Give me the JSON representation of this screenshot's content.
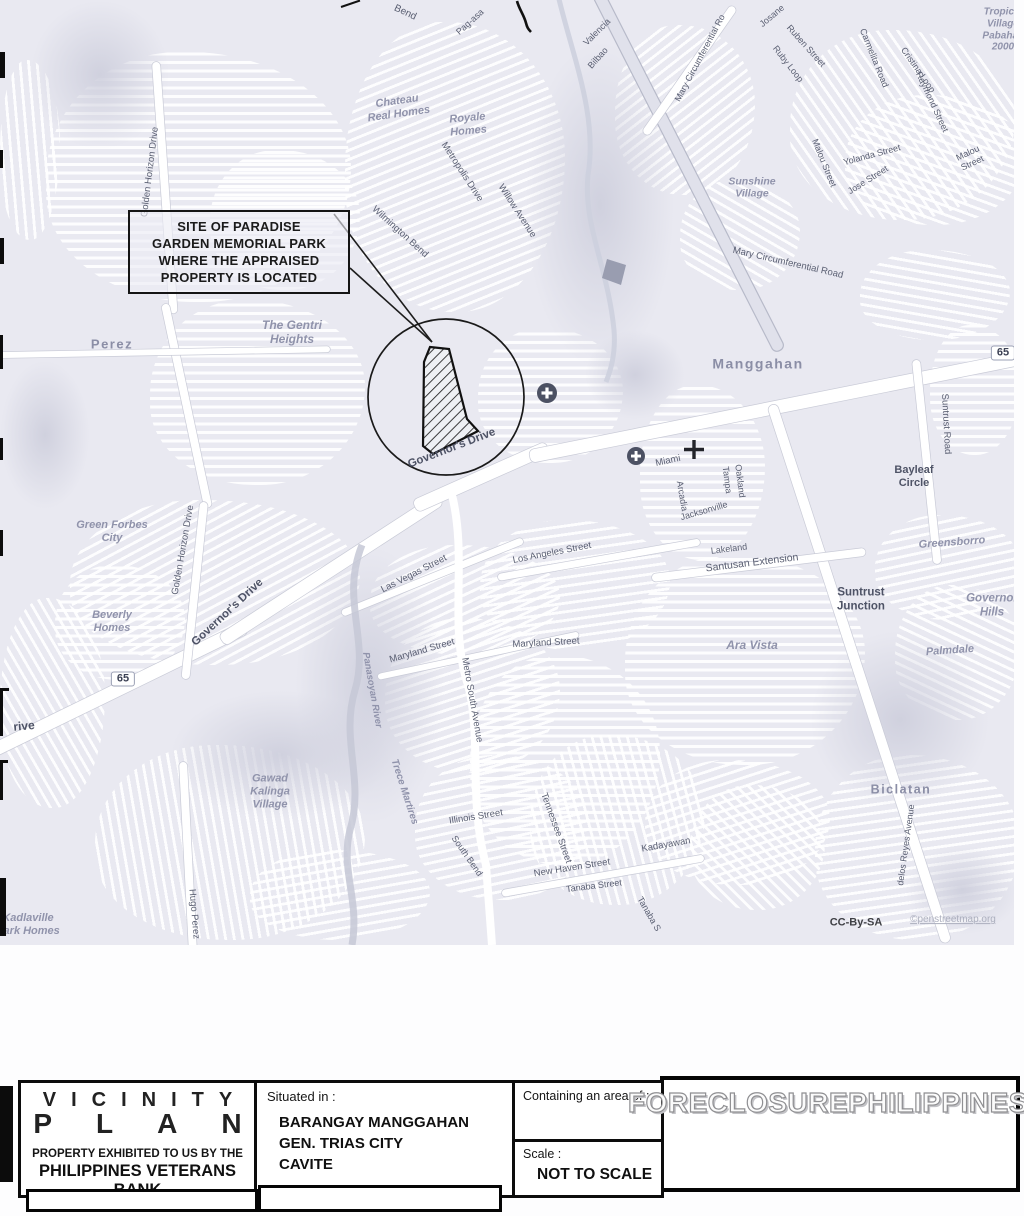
{
  "map": {
    "callout": {
      "text": "SITE OF PARADISE\nGARDEN MEMORIAL PARK\nWHERE THE APPRAISED\nPROPERTY IS LOCATED"
    },
    "labels": [
      {
        "t": "Bend",
        "x": 405,
        "y": 13,
        "r": 25,
        "c": "st",
        "s": 10
      },
      {
        "t": "Pag-asa",
        "x": 470,
        "y": 22,
        "r": -42,
        "c": "st",
        "s": 9
      },
      {
        "t": "Chateau\nReal Homes",
        "x": 398,
        "y": 108,
        "r": -8,
        "c": "pl",
        "s": 11
      },
      {
        "t": "Wilmington Bend",
        "x": 400,
        "y": 232,
        "r": 42,
        "c": "st",
        "s": 9.5
      },
      {
        "t": "Royale\nHomes",
        "x": 468,
        "y": 125,
        "r": -5,
        "c": "pl",
        "s": 11
      },
      {
        "t": "Metropolis Drive",
        "x": 462,
        "y": 172,
        "r": 57,
        "c": "st",
        "s": 9.5
      },
      {
        "t": "Willow Avenue",
        "x": 517,
        "y": 211,
        "r": 57,
        "c": "st",
        "s": 9.5
      },
      {
        "t": "Valencia",
        "x": 597,
        "y": 32,
        "r": -45,
        "c": "st",
        "s": 9
      },
      {
        "t": "Bilbao",
        "x": 598,
        "y": 58,
        "r": -48,
        "c": "st",
        "s": 9
      },
      {
        "t": "Mary Circumferential Ro",
        "x": 700,
        "y": 58,
        "r": -62,
        "c": "st",
        "s": 9
      },
      {
        "t": "Josane",
        "x": 772,
        "y": 16,
        "r": -40,
        "c": "st",
        "s": 9
      },
      {
        "t": "Ruben Street",
        "x": 806,
        "y": 46,
        "r": 48,
        "c": "st",
        "s": 9
      },
      {
        "t": "Ruby Loop",
        "x": 788,
        "y": 64,
        "r": 52,
        "c": "st",
        "s": 9
      },
      {
        "t": "Carmelita Road",
        "x": 874,
        "y": 58,
        "r": 68,
        "c": "st",
        "s": 9
      },
      {
        "t": "Cristina Loop",
        "x": 918,
        "y": 70,
        "r": 55,
        "c": "st",
        "s": 9
      },
      {
        "t": "Raymond Street",
        "x": 932,
        "y": 102,
        "r": 65,
        "c": "st",
        "s": 9
      },
      {
        "t": "Tropical\nVillage\nPabahay\n2000",
        "x": 1003,
        "y": 30,
        "r": 0,
        "c": "pl",
        "s": 10
      },
      {
        "t": "Yolanda Street",
        "x": 872,
        "y": 155,
        "r": -15,
        "c": "st",
        "s": 9
      },
      {
        "t": "Malou Street",
        "x": 824,
        "y": 163,
        "r": 68,
        "c": "st",
        "s": 9
      },
      {
        "t": "Jose Street",
        "x": 868,
        "y": 180,
        "r": -32,
        "c": "st",
        "s": 9
      },
      {
        "t": "Malou Street",
        "x": 970,
        "y": 158,
        "r": -25,
        "c": "st",
        "s": 9
      },
      {
        "t": "Sunshine\nVillage",
        "x": 752,
        "y": 188,
        "r": 0,
        "c": "pl",
        "s": 10.5
      },
      {
        "t": "Mary Circumferential Road",
        "x": 788,
        "y": 263,
        "r": 13,
        "c": "st",
        "s": 9.5
      },
      {
        "t": "Manggahan",
        "x": 758,
        "y": 364,
        "r": 0,
        "c": "town",
        "s": 14
      },
      {
        "t": "65",
        "x": 1003,
        "y": 353,
        "r": 0,
        "c": "shield",
        "s": 11
      },
      {
        "t": "Suntrust Road",
        "x": 946,
        "y": 424,
        "r": 87,
        "c": "st",
        "s": 9.5
      },
      {
        "t": "Bayleaf\nCircle",
        "x": 914,
        "y": 477,
        "r": 0,
        "c": "stb",
        "s": 11
      },
      {
        "t": "Governor's Drive",
        "x": 452,
        "y": 449,
        "r": -21,
        "c": "stb",
        "s": 11.5
      },
      {
        "t": "Governor's Drive",
        "x": 228,
        "y": 613,
        "r": -43,
        "c": "stb",
        "s": 11.5
      },
      {
        "t": "Golden Horizon Drive",
        "x": 150,
        "y": 172,
        "r": -83,
        "c": "st",
        "s": 9.5
      },
      {
        "t": "Golden Horizon Drive",
        "x": 183,
        "y": 550,
        "r": -80,
        "c": "st",
        "s": 9.5
      },
      {
        "t": "Perez",
        "x": 112,
        "y": 344,
        "r": 0,
        "c": "town",
        "s": 13
      },
      {
        "t": "The Gentri\nHeights",
        "x": 292,
        "y": 332,
        "r": 0,
        "c": "pl",
        "s": 12
      },
      {
        "t": "Green Forbes\nCity",
        "x": 112,
        "y": 532,
        "r": 0,
        "c": "pl",
        "s": 11
      },
      {
        "t": "Beverly\nHomes",
        "x": 112,
        "y": 622,
        "r": 0,
        "c": "pl",
        "s": 11
      },
      {
        "t": "65",
        "x": 123,
        "y": 679,
        "r": 0,
        "c": "shield",
        "s": 11
      },
      {
        "t": "rive",
        "x": 24,
        "y": 726,
        "r": -5,
        "c": "stb",
        "s": 12
      },
      {
        "t": "Las Vegas Street",
        "x": 414,
        "y": 574,
        "r": -27,
        "c": "st",
        "s": 9.5
      },
      {
        "t": "Los Angeles Street",
        "x": 552,
        "y": 553,
        "r": -11,
        "c": "st",
        "s": 9.5
      },
      {
        "t": "Maryland Street",
        "x": 422,
        "y": 651,
        "r": -16,
        "c": "st",
        "s": 9.5
      },
      {
        "t": "Maryland Street",
        "x": 546,
        "y": 643,
        "r": -3,
        "c": "st",
        "s": 9.5
      },
      {
        "t": "Metro South Avenue",
        "x": 472,
        "y": 700,
        "r": 80,
        "c": "st",
        "s": 9.5
      },
      {
        "t": "Panasoyan River",
        "x": 372,
        "y": 690,
        "r": 80,
        "c": "pl",
        "s": 9.5
      },
      {
        "t": "Trece Martires",
        "x": 404,
        "y": 792,
        "r": 72,
        "c": "pl",
        "s": 10
      },
      {
        "t": "Illinois Street",
        "x": 476,
        "y": 817,
        "r": -9,
        "c": "st",
        "s": 9.5
      },
      {
        "t": "South Bend",
        "x": 467,
        "y": 856,
        "r": 55,
        "c": "st",
        "s": 9
      },
      {
        "t": "Tennessee Street",
        "x": 556,
        "y": 828,
        "r": 70,
        "c": "st",
        "s": 9.5
      },
      {
        "t": "New Haven Street",
        "x": 572,
        "y": 868,
        "r": -9,
        "c": "st",
        "s": 9.5
      },
      {
        "t": "Tanaba Street",
        "x": 594,
        "y": 886,
        "r": -7,
        "c": "st",
        "s": 9
      },
      {
        "t": "Tanaba S",
        "x": 649,
        "y": 914,
        "r": 60,
        "c": "st",
        "s": 9
      },
      {
        "t": "Kadayawan",
        "x": 666,
        "y": 845,
        "r": -10,
        "c": "st",
        "s": 9.5
      },
      {
        "t": "Gawad\nKalinga\nVillage",
        "x": 270,
        "y": 792,
        "r": 0,
        "c": "pl",
        "s": 11
      },
      {
        "t": "Hugo Perez",
        "x": 194,
        "y": 914,
        "r": 85,
        "c": "st",
        "s": 9.5
      },
      {
        "t": "Kadlaville\nPark Homes",
        "x": 28,
        "y": 925,
        "r": 0,
        "c": "pl",
        "s": 11
      },
      {
        "t": "Ara Vista",
        "x": 752,
        "y": 645,
        "r": 0,
        "c": "pl",
        "s": 12
      },
      {
        "t": "Suntrust\nJunction",
        "x": 861,
        "y": 600,
        "r": 0,
        "c": "stb",
        "s": 11.5
      },
      {
        "t": "Greensborro",
        "x": 952,
        "y": 543,
        "r": -4,
        "c": "pl",
        "s": 11
      },
      {
        "t": "Governor\nHills",
        "x": 992,
        "y": 606,
        "r": 0,
        "c": "pl",
        "s": 11.5
      },
      {
        "t": "Palmdale",
        "x": 950,
        "y": 651,
        "r": -4,
        "c": "pl",
        "s": 11
      },
      {
        "t": "Biclatan",
        "x": 901,
        "y": 790,
        "r": 0,
        "c": "town",
        "s": 12.5
      },
      {
        "t": "delos Reyes Avenue",
        "x": 906,
        "y": 845,
        "r": -82,
        "c": "st",
        "s": 9
      },
      {
        "t": "Lakeland",
        "x": 729,
        "y": 549,
        "r": -7,
        "c": "st",
        "s": 9
      },
      {
        "t": "Santusan Extension",
        "x": 752,
        "y": 563,
        "r": -7,
        "c": "st",
        "s": 10.5
      },
      {
        "t": "Miami",
        "x": 668,
        "y": 461,
        "r": -12,
        "c": "st",
        "s": 9.5
      },
      {
        "t": "Arcadia",
        "x": 682,
        "y": 496,
        "r": 80,
        "c": "st",
        "s": 9
      },
      {
        "t": "Jacksonville",
        "x": 704,
        "y": 511,
        "r": -16,
        "c": "st",
        "s": 9
      },
      {
        "t": "Tampa",
        "x": 727,
        "y": 480,
        "r": 83,
        "c": "st",
        "s": 9
      },
      {
        "t": "Oakland",
        "x": 740,
        "y": 481,
        "r": 83,
        "c": "st",
        "s": 9
      },
      {
        "t": "CC-By-SA",
        "x": 856,
        "y": 923,
        "r": 0,
        "c": "attr1",
        "s": 11
      },
      {
        "t": "©penstreetmap.org",
        "x": 953,
        "y": 920,
        "r": 0,
        "c": "attr2",
        "s": 10
      }
    ]
  },
  "titleblock": {
    "title_line1": "VICINITY",
    "title_line2": "PLAN",
    "exhibited_by": "PROPERTY EXHIBITED TO US BY THE",
    "bank": "PHILIPPINES VETERANS BANK",
    "situated_label": "Situated in :",
    "situated_value": "BARANGAY MANGGAHAN\nGEN. TRIAS CITY\nCAVITE",
    "area_label": "Containing an area of :",
    "scale_label": "Scale :",
    "scale_value": "NOT TO SCALE",
    "watermark": "FORECLOSUREPHILIPPINES.COM"
  }
}
